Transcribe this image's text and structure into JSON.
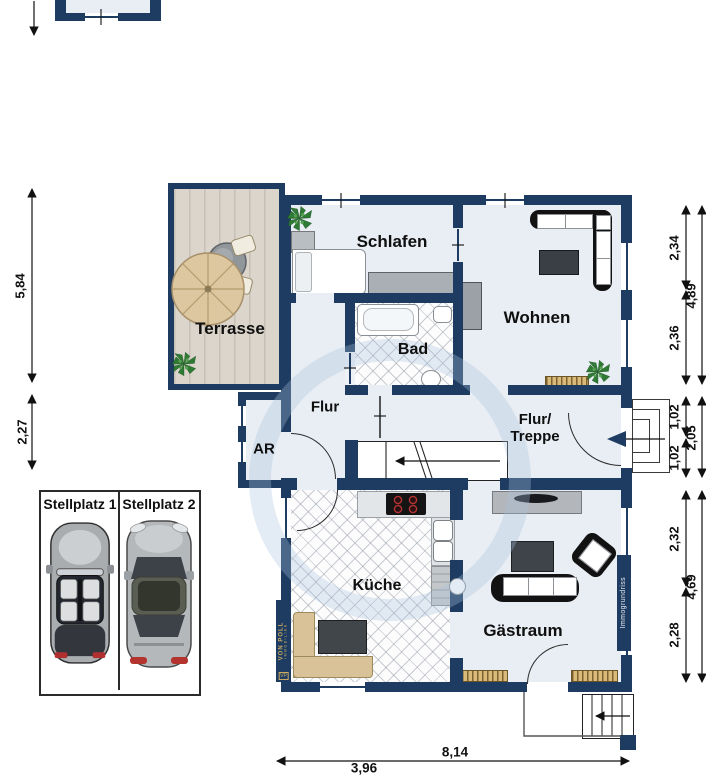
{
  "colors": {
    "wall": "#1e3c61",
    "gold": "#c9ab61",
    "floor": "#e9eef4",
    "deck": "#dbd5cb"
  },
  "rooms": {
    "terrasse": "Terrasse",
    "schlafen": "Schlafen",
    "wohnen": "Wohnen",
    "bad": "Bad",
    "flur": "Flur",
    "ar": "AR",
    "flur_treppe": "Flur/\nTreppe",
    "kueche": "Küche",
    "gaestraum": "Gästraum"
  },
  "parking": {
    "stellplatz1": "Stellplatz 1",
    "stellplatz2": "Stellplatz 2"
  },
  "dimensions": {
    "terrace_height": "5,84",
    "ar_height": "2,27",
    "wohnen_upper": "2,34",
    "wohnen_lower": "2,36",
    "wohnen_total": "4,89",
    "entry_upper": "1,02",
    "entry_lower": "1,02",
    "entry_total": "2,05",
    "gaestraum_upper": "2,32",
    "gaestraum_lower": "2,28",
    "gaestraum_total": "4,69",
    "bottom_total": "8,14",
    "bottom_partial": "3,96"
  },
  "branding": {
    "vp_monogram": "VP",
    "vp_name": "VON POLL",
    "vp_sub": "IMMOBILIEN",
    "watermark": "Immogrundriss"
  },
  "icons": {
    "plant": "plant-icon",
    "parasol": "parasol-icon",
    "patio_table": "patio-table-icon",
    "car_left": "convertible-car-icon",
    "car_right": "coupe-car-icon",
    "entry_arrow": "entry-direction-arrow-icon",
    "stairs_arrow": "stairs-direction-arrow-icon"
  }
}
